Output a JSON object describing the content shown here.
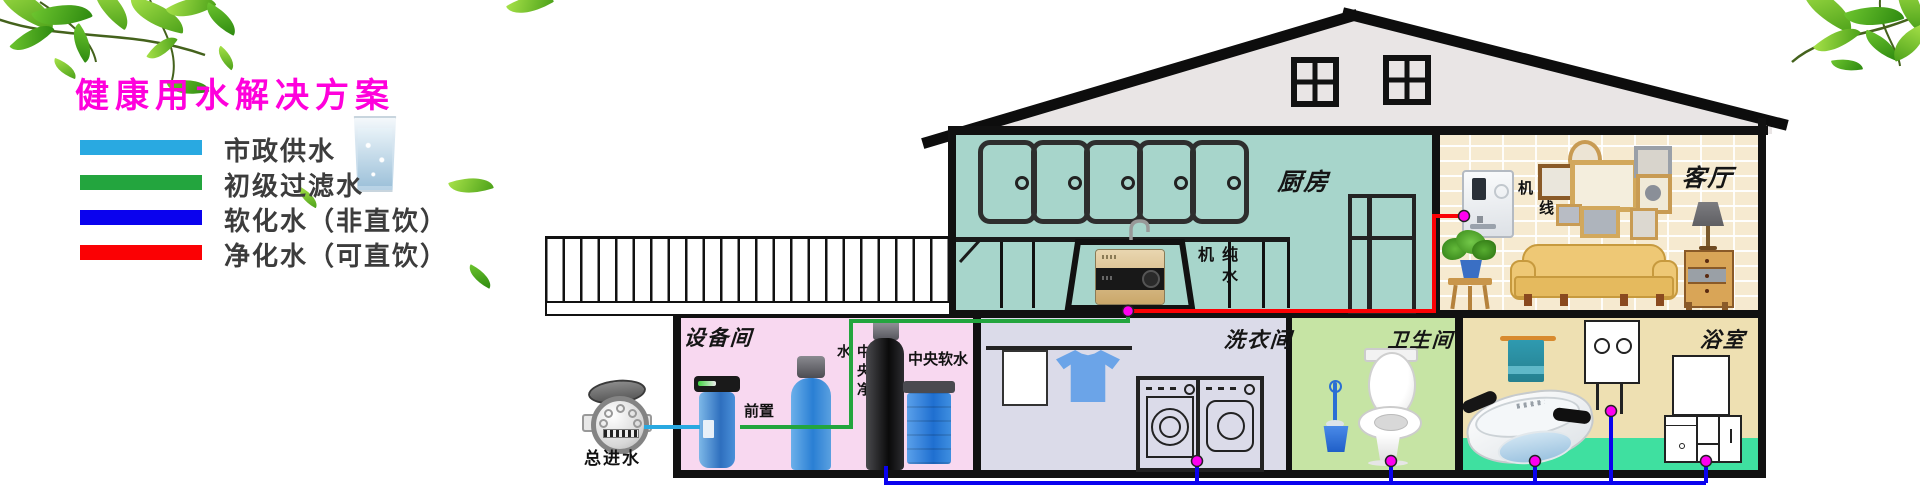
{
  "title": {
    "text": "健康用水解决方案",
    "color": "#ff00dc"
  },
  "legend": {
    "items": [
      {
        "label": "市政供水",
        "color": "#29a9e1"
      },
      {
        "label": "初级过滤水",
        "color": "#23a53e"
      },
      {
        "label": "软化水（非直饮）",
        "color": "#0a02ee"
      },
      {
        "label": "净化水（可直饮）",
        "color": "#fb0104"
      }
    ]
  },
  "rooms": {
    "kitchen": "厨房",
    "living_room": "客厅",
    "equipment_room": "设备间",
    "laundry_room": "洗衣间",
    "toilet_room": "卫生间",
    "bathroom": "浴室"
  },
  "devices": {
    "main_inlet": "总进水",
    "prefilter": "前置",
    "central_purifier": "中央净水",
    "central_softener": "中央软水",
    "pure_water_machine": "纯水机",
    "pipeline_machine": "管线机"
  },
  "pipes": {
    "junction_dot_color": "#ff00f0"
  }
}
